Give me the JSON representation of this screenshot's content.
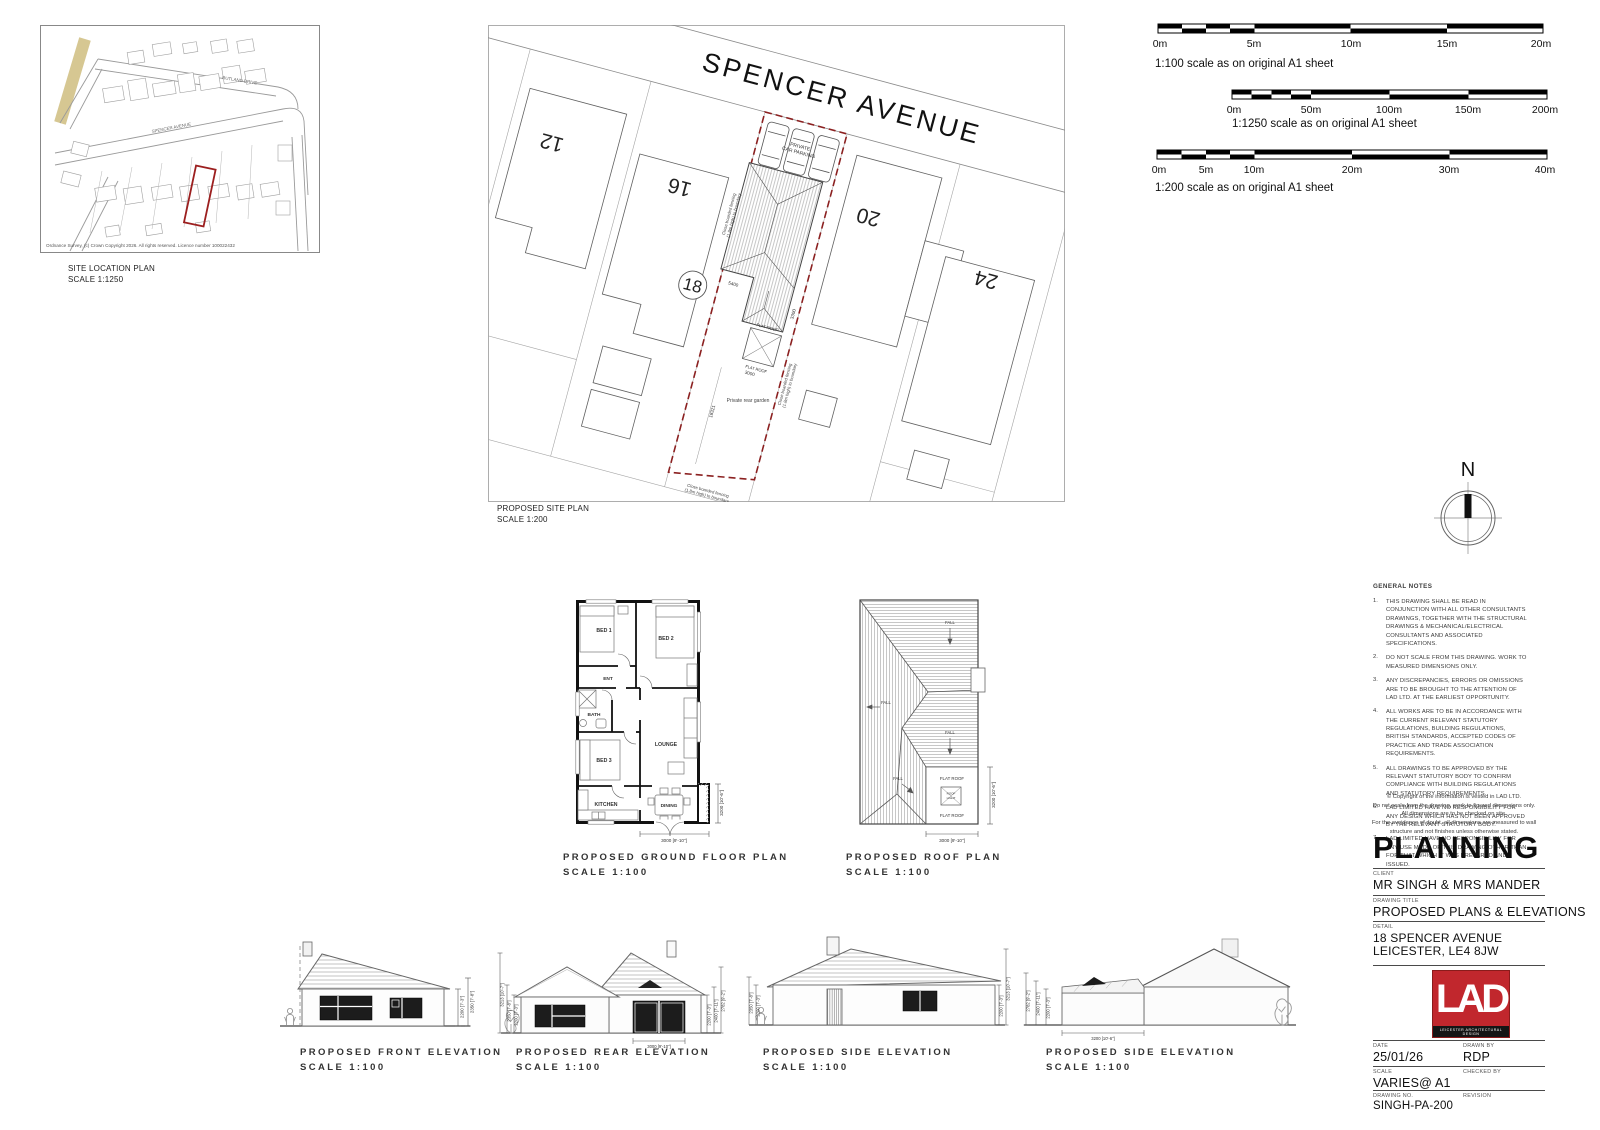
{
  "site_location": {
    "title": "SITE LOCATION PLAN",
    "scale": "SCALE 1:1250",
    "street_spencer": "SPENCER AVENUE",
    "street_rutland": "RUTLAND DRIVE",
    "copyright": "Ordnance Survey, (c) Crown Copyright 2026. All rights reserved. Licence number 100022432",
    "plot_color": "#9c1f1f",
    "accent_color": "#d6c792"
  },
  "site_plan": {
    "title": "PROPOSED SITE PLAN",
    "scale": "SCALE 1:200",
    "street": "SPENCER AVENUE",
    "plot_12": "12",
    "plot_16": "16",
    "plot_20": "20",
    "plot_24": "24",
    "plot_18": "18",
    "parking_line1": "PRIVATE",
    "parking_line2": "CAR PARKING",
    "garden_label": "Private rear garden",
    "fence_line1": "Close boarded fencing",
    "fence_line2": "(1.8m high) to boundary",
    "flat_roof": "FLAT ROOF",
    "dim_garden": "18321",
    "dim_front": "5400",
    "dim_width": "3000",
    "dim_side": "3300",
    "boundary_color": "#8b2020"
  },
  "scale_bars": [
    {
      "ticks": [
        "0m",
        "5m",
        "10m",
        "15m",
        "20m"
      ],
      "label": "1:100 scale as on original A1 sheet"
    },
    {
      "ticks": [
        "0m",
        "50m",
        "100m",
        "150m",
        "200m"
      ],
      "label": "1:1250 scale as on original A1 sheet"
    },
    {
      "ticks": [
        "0m",
        "5m",
        "10m",
        "20m",
        "30m",
        "40m"
      ],
      "label": "1:200 scale as on original A1 sheet"
    }
  ],
  "north_label": "N",
  "floor_plan": {
    "title": "PROPOSED GROUND FLOOR PLAN",
    "scale": "SCALE 1:100",
    "rooms": {
      "bed1": "BED 1",
      "bed2": "BED 2",
      "ent": "ENT",
      "bath": "BATH",
      "bed3": "BED 3",
      "lounge": "LOUNGE",
      "kitchen": "KITCHEN",
      "dining": "DINING"
    },
    "dim_right": "3200 [10'-6\"]",
    "dim_bottom": "3000 [9'-10\"]"
  },
  "roof_plan": {
    "title": "PROPOSED ROOF PLAN",
    "scale": "SCALE 1:100",
    "fall": "FALL",
    "flat_roof": "FLAT ROOF",
    "roof_light_line1": "ROOF",
    "roof_light_line2": "LIGHT",
    "dim_right": "3200 [10'-6\"]",
    "dim_bottom": "3000 [9'-10\"]"
  },
  "elevations": {
    "front": {
      "title": "PROPOSED FRONT ELEVATION",
      "scale": "SCALE 1:100",
      "dim_r1": "2200 [7'-3\"]",
      "dim_r2": "2350 [7'-8\"]"
    },
    "rear": {
      "title": "PROPOSED REAR ELEVATION",
      "scale": "SCALE 1:100",
      "dim_l1": "3213 [10'-7\"]",
      "dim_l2": "2350 [7'-8\"]",
      "dim_l3": "2200 [7'-3\"]",
      "dim_r1": "2200 [7'-3\"]",
      "dim_r2": "2400 [7'-11\"]",
      "dim_r3": "2782 [9'-2\"]",
      "dim_bottom": "3000 [9'-10\"]"
    },
    "side1": {
      "title": "PROPOSED SIDE ELEVATION",
      "scale": "SCALE 1:100",
      "dim_l1": "2350 [7'-8\"]",
      "dim_l2": "2200 [7'-3\"]",
      "dim_r1": "2200 [7'-3\"]",
      "dim_r2": "3213 [10'-7\"]"
    },
    "side2": {
      "title": "PROPOSED SIDE ELEVATION",
      "scale": "SCALE 1:100",
      "dim_l1": "2782 [9'-2\"]",
      "dim_l2": "2400 [7'-11\"]",
      "dim_l3": "2200 [7'-3\"]",
      "dim_bottom": "3200 [10'-6\"]"
    }
  },
  "notes": {
    "heading": "GENERAL NOTES",
    "items": [
      {
        "num": "1.",
        "text": "THIS DRAWING SHALL BE READ IN CONJUNCTION WITH ALL OTHER CONSULTANTS DRAWINGS, TOGETHER WITH THE STRUCTURAL DRAWINGS & MECHANICAL/ELECTRICAL CONSULTANTS AND ASSOCIATED SPECIFICATIONS."
      },
      {
        "num": "2.",
        "text": "DO NOT SCALE FROM THIS DRAWING. WORK TO MEASURED DIMENSIONS ONLY."
      },
      {
        "num": "3.",
        "text": "ANY DISCREPANCIES, ERRORS OR OMISSIONS ARE TO BE BROUGHT TO THE ATTENTION OF LAD LTD. AT THE EARLIEST OPPORTUNITY."
      },
      {
        "num": "4.",
        "text": "ALL WORKS ARE TO BE IN ACCORDANCE WITH THE CURRENT RELEVANT STATUTORY REGULATIONS, BUILDING REGULATIONS, BRITISH STANDARDS, ACCEPTED CODES OF PRACTICE AND TRADE ASSOCIATION REQUIREMENTS."
      },
      {
        "num": "5.",
        "text": "ALL DRAWINGS TO BE APPROVED BY THE RELEVANT STATUTORY BODY TO CONFIRM COMPLIANCE WITH BUILDING REGULATIONS AND STATUTORY REQUIREMENTS."
      },
      {
        "num": "6.",
        "text": "LAD LIMITED HAVE NO RESPONSIBILITY FOR ANY DESIGN WHICH HAS NOT BEEN APPROVED BY THE RELEVANT STATUTORY BODY."
      },
      {
        "num": "7.",
        "text": "LAD LIMITED HAVE NO RESPONSIBILITY FOR ANY USE MADE OF THIS DRAWING OTHER THAN FOR THAT WHICH IT WAS PREPARED AND ISSUED."
      }
    ],
    "copyright_lines": [
      "© Copyright of the information is vested in LAD LTD.",
      "Do not scale from the drawing, work to figured dimensions only.",
      "All dimensions are to be checked on site.",
      "For the avoidance of doubt, all dimensions are measured to wall",
      "structure and not finishes unless otherwise stated."
    ]
  },
  "title_block": {
    "heading": "PLANNING",
    "client_label": "CLIENT",
    "client": "MR SINGH & MRS MANDER",
    "drawing_title_label": "DRAWING TITLE",
    "drawing_title": "PROPOSED PLANS & ELEVATIONS",
    "detail_label": "DETAIL",
    "detail_line1": "18 SPENCER AVENUE",
    "detail_line2": "LEICESTER, LE4 8JW",
    "logo_text": "LAD",
    "logo_sub": "LEICESTER ARCHITECTURAL DESIGN",
    "logo_color": "#c1272d",
    "date_label": "DATE",
    "date": "25/01/26",
    "drawn_label": "DRAWN BY",
    "drawn": "RDP",
    "scale_label": "SCALE",
    "scale_value": "VARIES@ A1",
    "checked_label": "CHECKED BY",
    "checked": "",
    "dwg_label": "DRAWING NO.",
    "dwg_no": "SINGH-PA-200",
    "rev_label": "REVISION",
    "revision": ""
  }
}
